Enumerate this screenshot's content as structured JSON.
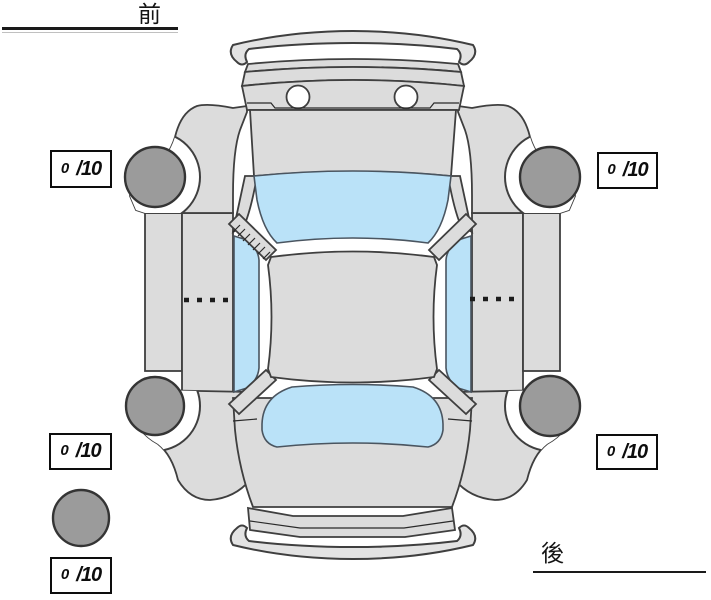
{
  "labels": {
    "front": "前",
    "rear": "後"
  },
  "tire_ratings": {
    "front_left": {
      "value": "0",
      "denominator": "/10"
    },
    "front_right": {
      "value": "0",
      "denominator": "/10"
    },
    "rear_left": {
      "value": "0",
      "denominator": "/10"
    },
    "rear_right": {
      "value": "0",
      "denominator": "/10"
    },
    "spare": {
      "value": "0",
      "denominator": "/10"
    }
  },
  "diagram": {
    "type": "car-top-view-tire-condition",
    "colors": {
      "body": "#dcdcdc",
      "bumper": "#e3e3e3",
      "glass": "#bae2f8",
      "tire": "#9b9b9b",
      "outline": "#3f3f3f"
    }
  }
}
